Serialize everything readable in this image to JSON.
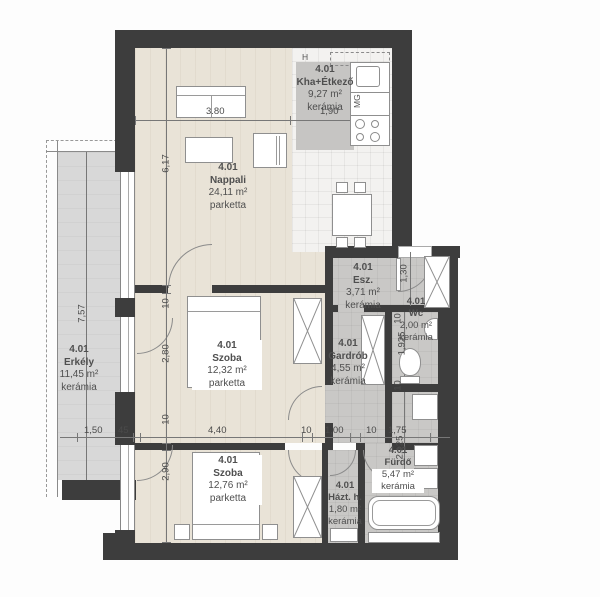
{
  "plan_title": "Apartment 4.01 floor plan",
  "rooms": {
    "nappali": {
      "number": "4.01",
      "name": "Nappali",
      "area": "24,11 m²",
      "floor": "parketta"
    },
    "kha": {
      "number": "4.01",
      "name": "Kha+Étkező",
      "area": "9,27 m²",
      "floor": "kerámia"
    },
    "esz": {
      "number": "4.01",
      "name": "Esz.",
      "area": "3,71 m²",
      "floor": "kerámia"
    },
    "wc": {
      "number": "4.01",
      "name": "Wc",
      "area": "2,00 m²",
      "floor": "kerámia"
    },
    "szoba1": {
      "number": "4.01",
      "name": "Szoba",
      "area": "12,32 m²",
      "floor": "parketta"
    },
    "gardrob": {
      "number": "4.01",
      "name": "Gardrób",
      "area": "4,55 m²",
      "floor": "kerámia"
    },
    "szoba2": {
      "number": "4.01",
      "name": "Szoba",
      "area": "12,76 m²",
      "floor": "parketta"
    },
    "hazt": {
      "number": "4.01",
      "name": "Házt. h.",
      "area": "1,80 m²",
      "floor": "kerámia"
    },
    "furdo": {
      "number": "4.01",
      "name": "Fürdő",
      "area": "5,47 m²",
      "floor": "kerámia"
    },
    "erkely": {
      "number": "4.01",
      "name": "Erkély",
      "area": "11,45 m²",
      "floor": "kerámia"
    }
  },
  "dimensions": {
    "nappali_w": "3.80",
    "kha_w": "1,90",
    "nappali_h": "6,17",
    "erkely_h": "7,57",
    "erkely_w": "1,50",
    "wall45": "45",
    "w10": "10",
    "szoba1_h": "2,80",
    "szoba2_h": "2,90",
    "szoba_w": "4,40",
    "hazt_w": "1,00",
    "furdo_w": "1,75",
    "esz_h": "1,30",
    "wc_h": "1,925",
    "furdo_h": "2,125"
  },
  "appliances": {
    "fridge": "H",
    "dishwasher": "MG"
  },
  "colors": {
    "wall": "#3d3d3d",
    "parquet": "#e9e3d7",
    "ceramic_grey": "#c9c8c6",
    "tile": "#f3f2f0",
    "balcony": "#d8d8d8"
  }
}
